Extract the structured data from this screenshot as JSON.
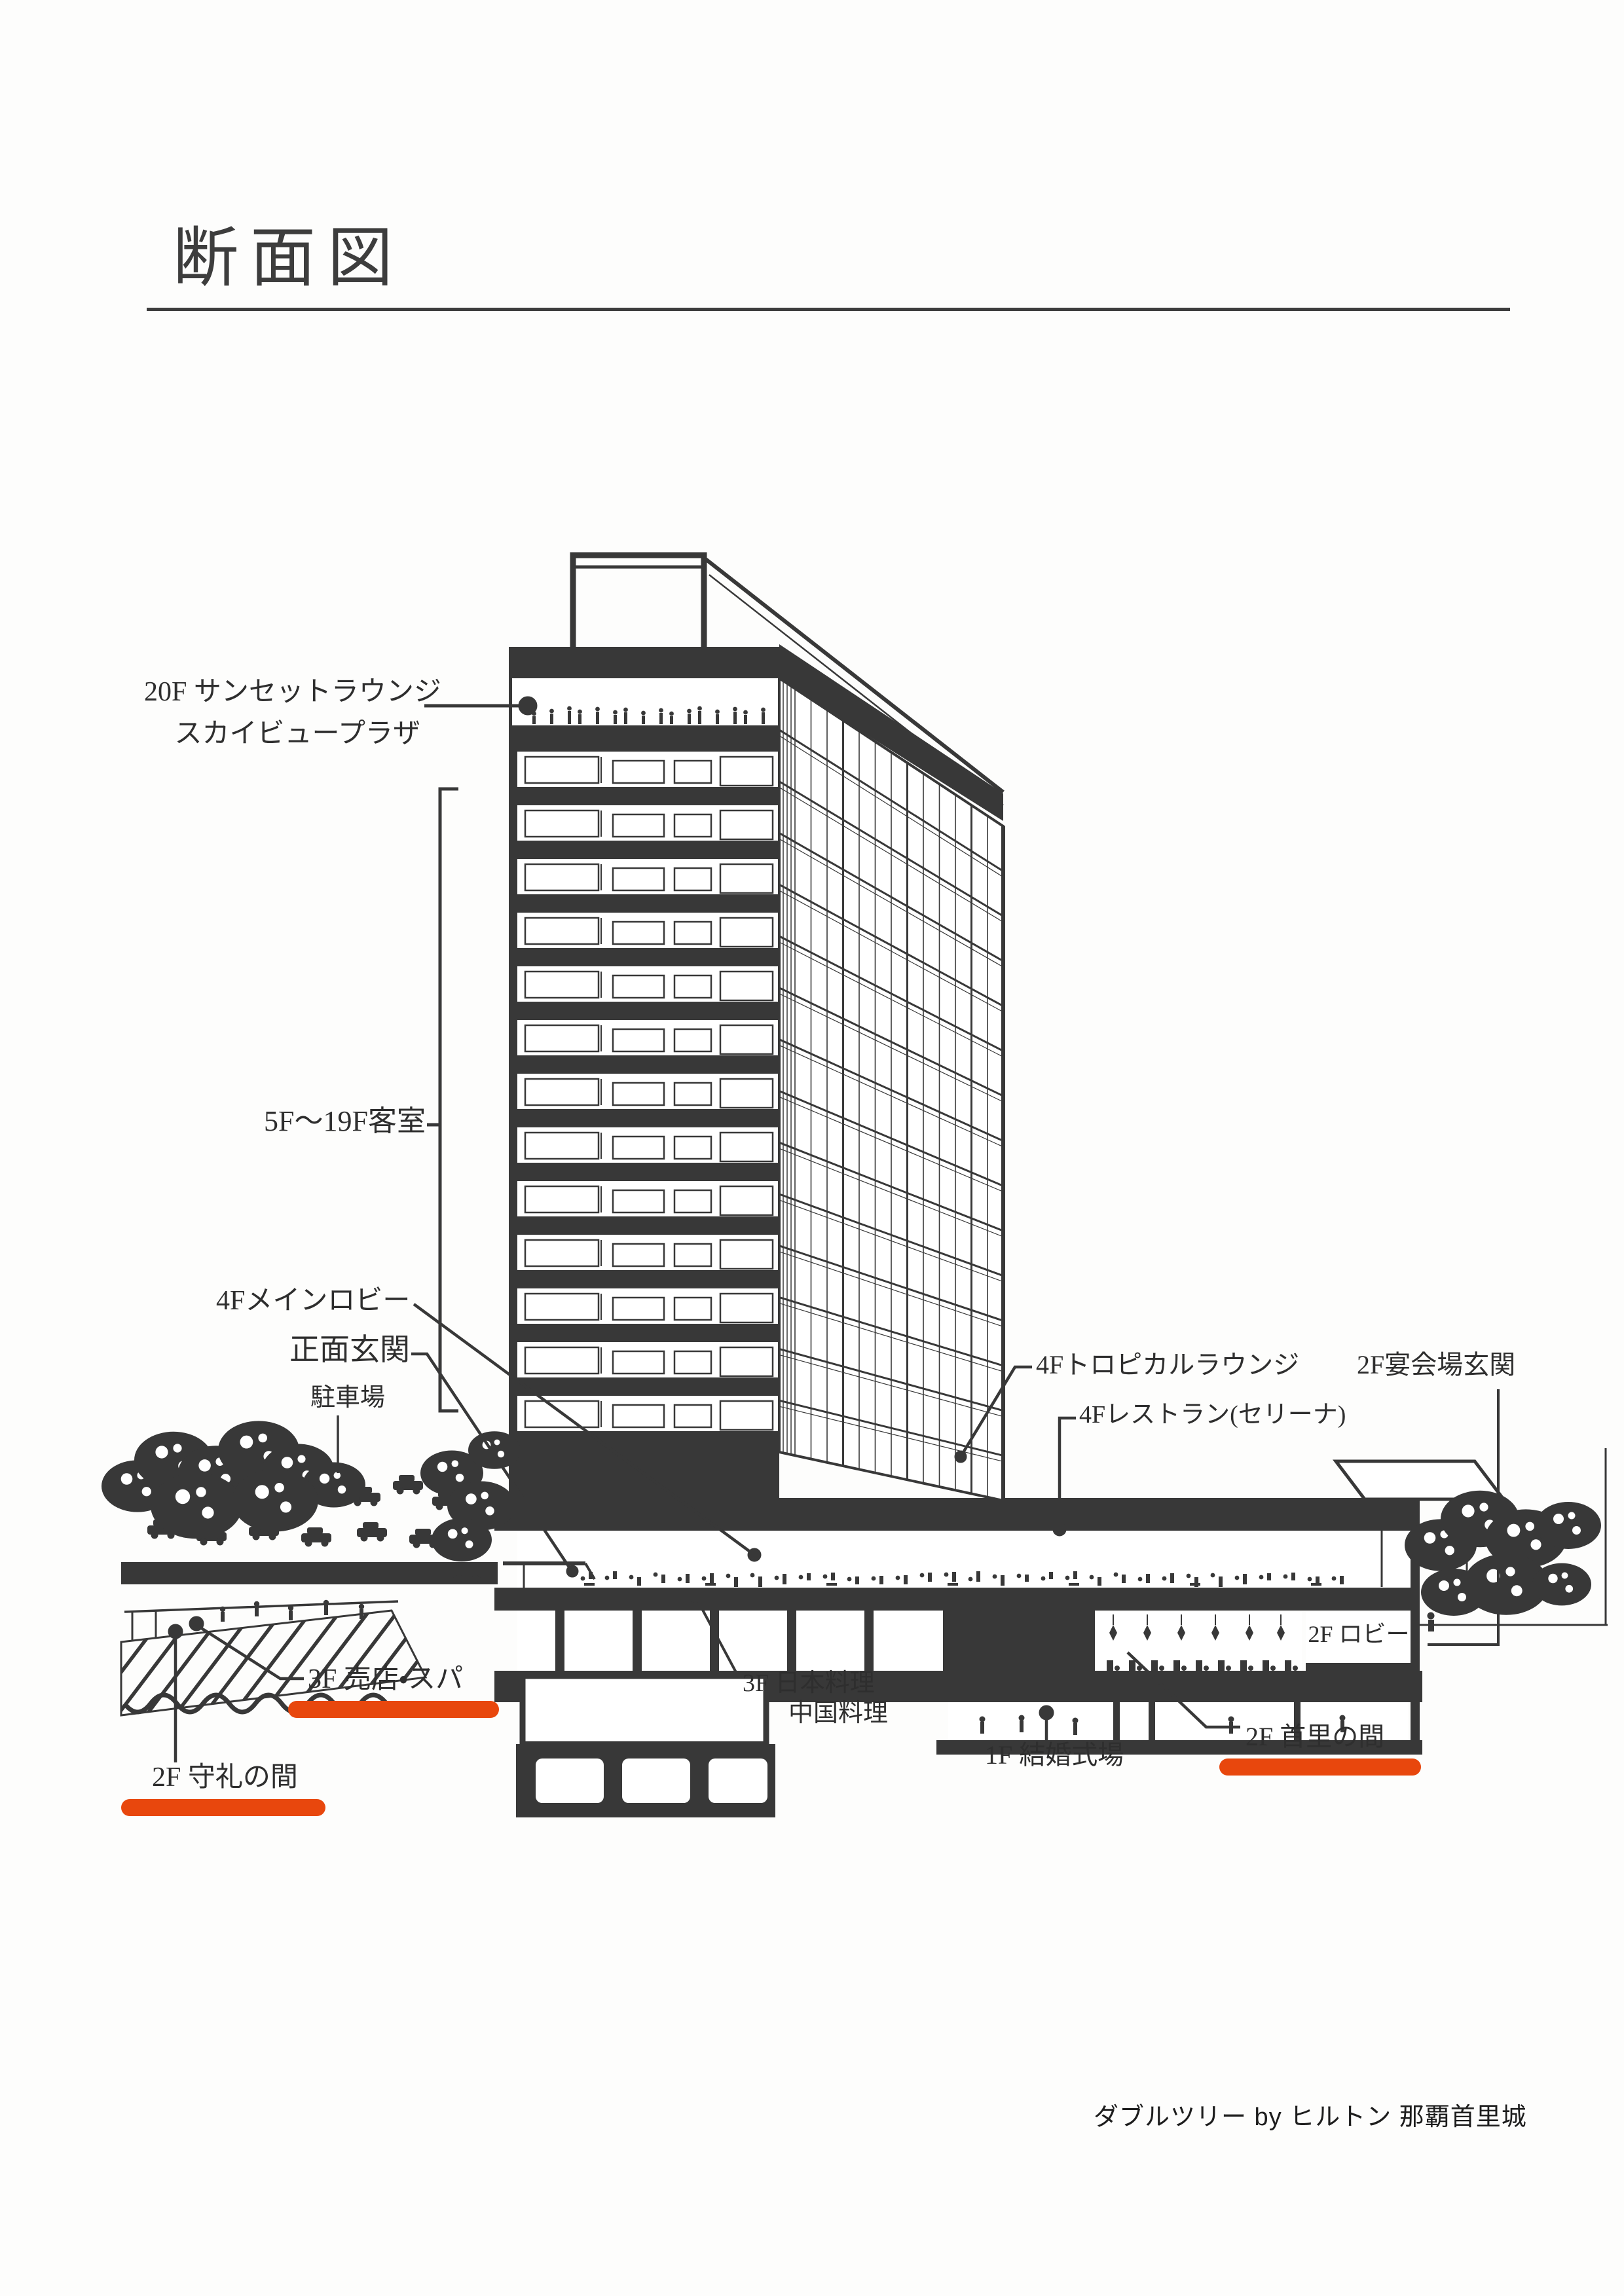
{
  "page": {
    "title": "断面図",
    "caption": "ダブルツリー by ヒルトン 那覇首里城"
  },
  "colors": {
    "ink": "#383838",
    "accent_orange": "#E8470D",
    "title_gray": "#3d3d3d"
  },
  "labels": {
    "sunset_lounge_line1": "20F サンセットラウンジ",
    "sunset_lounge_line2": "スカイビュープラザ",
    "guest_rooms": "5F〜19F客室",
    "main_lobby_4f": "4Fメインロビー",
    "front_entrance": "正面玄関",
    "parking": "駐車場",
    "tropical_lounge_4f": "4Fトロピカルラウンジ",
    "banquet_entrance_2f": "2F宴会場玄関",
    "restaurant_4f": "4Fレストラン(セリーナ)",
    "lobby_2f": "2F ロビー",
    "shop_spa_3f": "3F 売店・スパ",
    "japanese_cuisine_3f": "3F 日本料理",
    "chinese_cuisine": "中国料理",
    "wedding_hall_1f": "1F 結婚式場",
    "shuri_room_2f": "2F 首里の間",
    "shurei_room_2f": "2F 守礼の間"
  }
}
